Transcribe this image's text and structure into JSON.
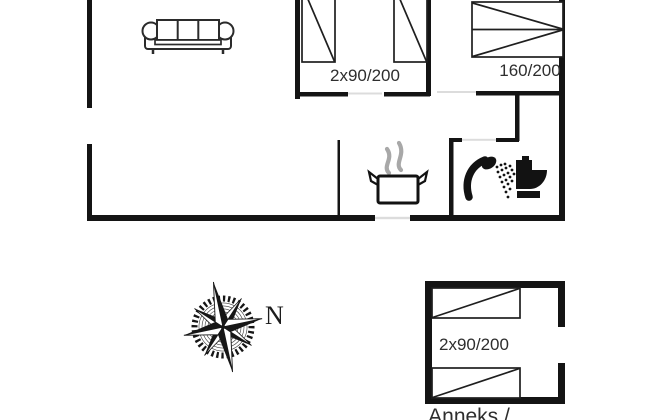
{
  "floorplan": {
    "main_house": {
      "living_room": {
        "icon": "sofa-icon"
      },
      "bedroom_middle": {
        "bed_label": "2x90/200"
      },
      "bedroom_right": {
        "bed_label": "160/200"
      },
      "kitchen": {
        "icon": "cooking-pot-steam-icon"
      },
      "bathroom": {
        "icons": [
          "shower-icon",
          "toilet-icon"
        ]
      }
    },
    "annex": {
      "bed_label": "2x90/200",
      "title": "Anneks /"
    },
    "compass": {
      "north_label": "N",
      "icon": "compass-rose-icon"
    }
  },
  "colors": {
    "wall": "#141414",
    "bed_line": "#1f1f1f",
    "door_opening": "#dcdcdc",
    "steam_gray": "#a8a8a8",
    "label_text": "#2e2e2e",
    "background": "#ffffff"
  }
}
